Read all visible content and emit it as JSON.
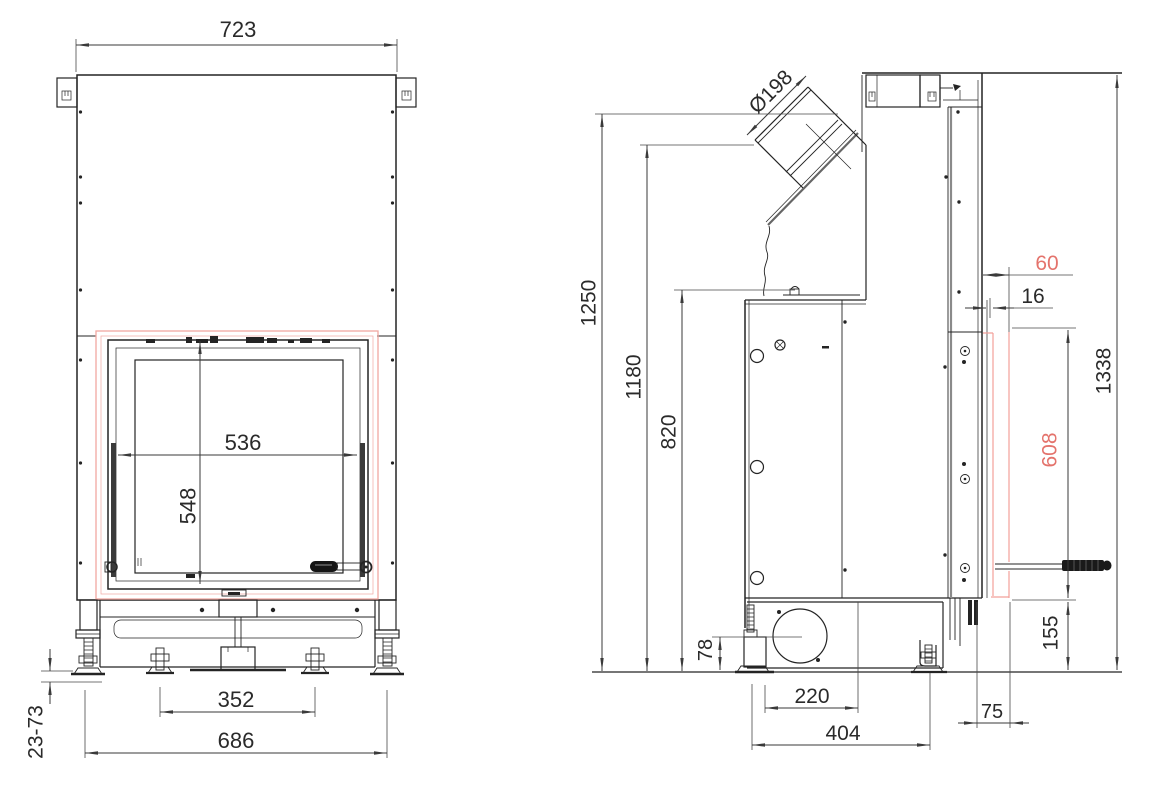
{
  "drawing": {
    "colors": {
      "background": "#ffffff",
      "line": "#242424",
      "dimension": "#3a3a3a",
      "red_text": "#e4736c",
      "red_line": "#f2a09a",
      "pink_frame": "#f0a8a2"
    },
    "front_view": {
      "dims": {
        "overall_width": "723",
        "glass_width": "536",
        "glass_height": "548",
        "inner_feet_spacing": "352",
        "outer_feet_spacing": "686",
        "leveling_feet_range": "23-73"
      }
    },
    "side_view": {
      "dims": {
        "flue_diameter": "Ø198",
        "flue_top_height": "1250",
        "flue_mouth_height": "1180",
        "body_top_height": "820",
        "air_inlet_center_height": "78",
        "air_inlet_offset": "220",
        "feet_spacing_depth": "404",
        "front_overhang": "75",
        "handle_zone_height": "155",
        "frame_height": "608",
        "overall_height": "1338",
        "frame_depth": "60",
        "frame_lip": "16"
      }
    }
  }
}
